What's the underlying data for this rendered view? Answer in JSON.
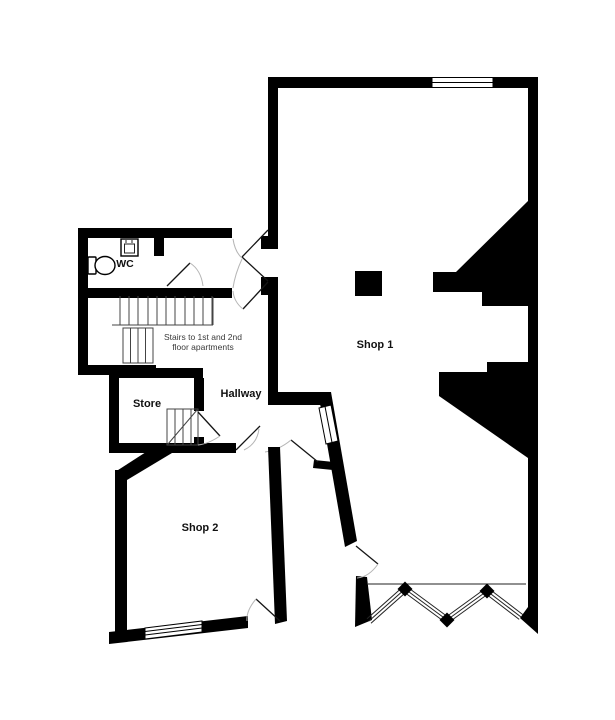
{
  "rooms": {
    "shop1": {
      "label": "Shop 1"
    },
    "shop2": {
      "label": "Shop 2"
    },
    "store": {
      "label": "Store"
    },
    "hallway": {
      "label": "Hallway"
    },
    "wc": {
      "label": "WC"
    }
  },
  "annotations": {
    "stairs_line1": "Stairs to 1st and 2nd",
    "stairs_line2": "floor apartments"
  },
  "colors": {
    "wall": "#000000",
    "background": "#ffffff",
    "door_arc": "#b5b5b5",
    "stair_line": "#444444",
    "text": "#111111",
    "note_text": "#3a3a3a"
  }
}
